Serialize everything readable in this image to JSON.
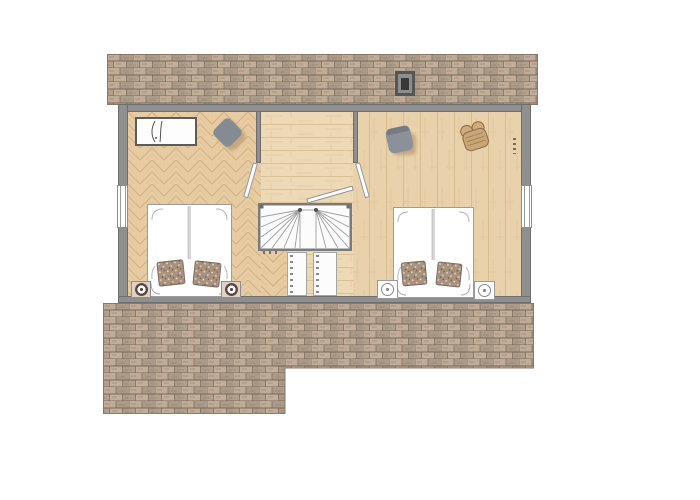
{
  "meta": {
    "type": "architectural-floor-plan",
    "view": "top-down",
    "description": "Upper-floor plan: two bedrooms flanking a central landing with winder staircase; shingled roof strips above and below the building outline"
  },
  "colors": {
    "page_bg": "#ffffff",
    "wall": "#8f8f8f",
    "wall_edge": "#6e6e6e",
    "roof_base": "#b6a492",
    "roof_joint": "#6e5f51",
    "floor_left_room": "#e7cba2",
    "floor_landing": "#eed9b6",
    "floor_right_room": "#e9d2ab",
    "furniture_white": "#fdfdfd",
    "chair_gray": "#858b92",
    "wicker_tan": "#c9a678",
    "pillow_base": "#a8927e",
    "chimney_dark": "#383838"
  },
  "exterior": {
    "roof_top": "shingle-roof-strip-with-chimney",
    "roof_bottom": "l-shaped-shingle-roof",
    "windows": [
      "left-wall-window",
      "right-wall-window"
    ]
  },
  "rooms": [
    {
      "name": "bedroom-left",
      "floor": "herringbone-parquet",
      "furniture": [
        "dresser",
        "gray-armchair",
        "double-bed-with-two-pillows",
        "nightstand-with-lamp-left",
        "nightstand-with-lamp-right",
        "door"
      ]
    },
    {
      "name": "landing",
      "floor": "wood-planks",
      "furniture": [
        "winder-staircase",
        "handrail",
        "balustrade-left",
        "balustrade-right"
      ]
    },
    {
      "name": "bedroom-right",
      "floor": "wood-planks",
      "furniture": [
        "gray-tub-chair",
        "wicker-armchair",
        "double-bed-with-two-pillows",
        "nightstand-with-lamp-left",
        "nightstand-with-lamp-right",
        "door"
      ]
    }
  ]
}
